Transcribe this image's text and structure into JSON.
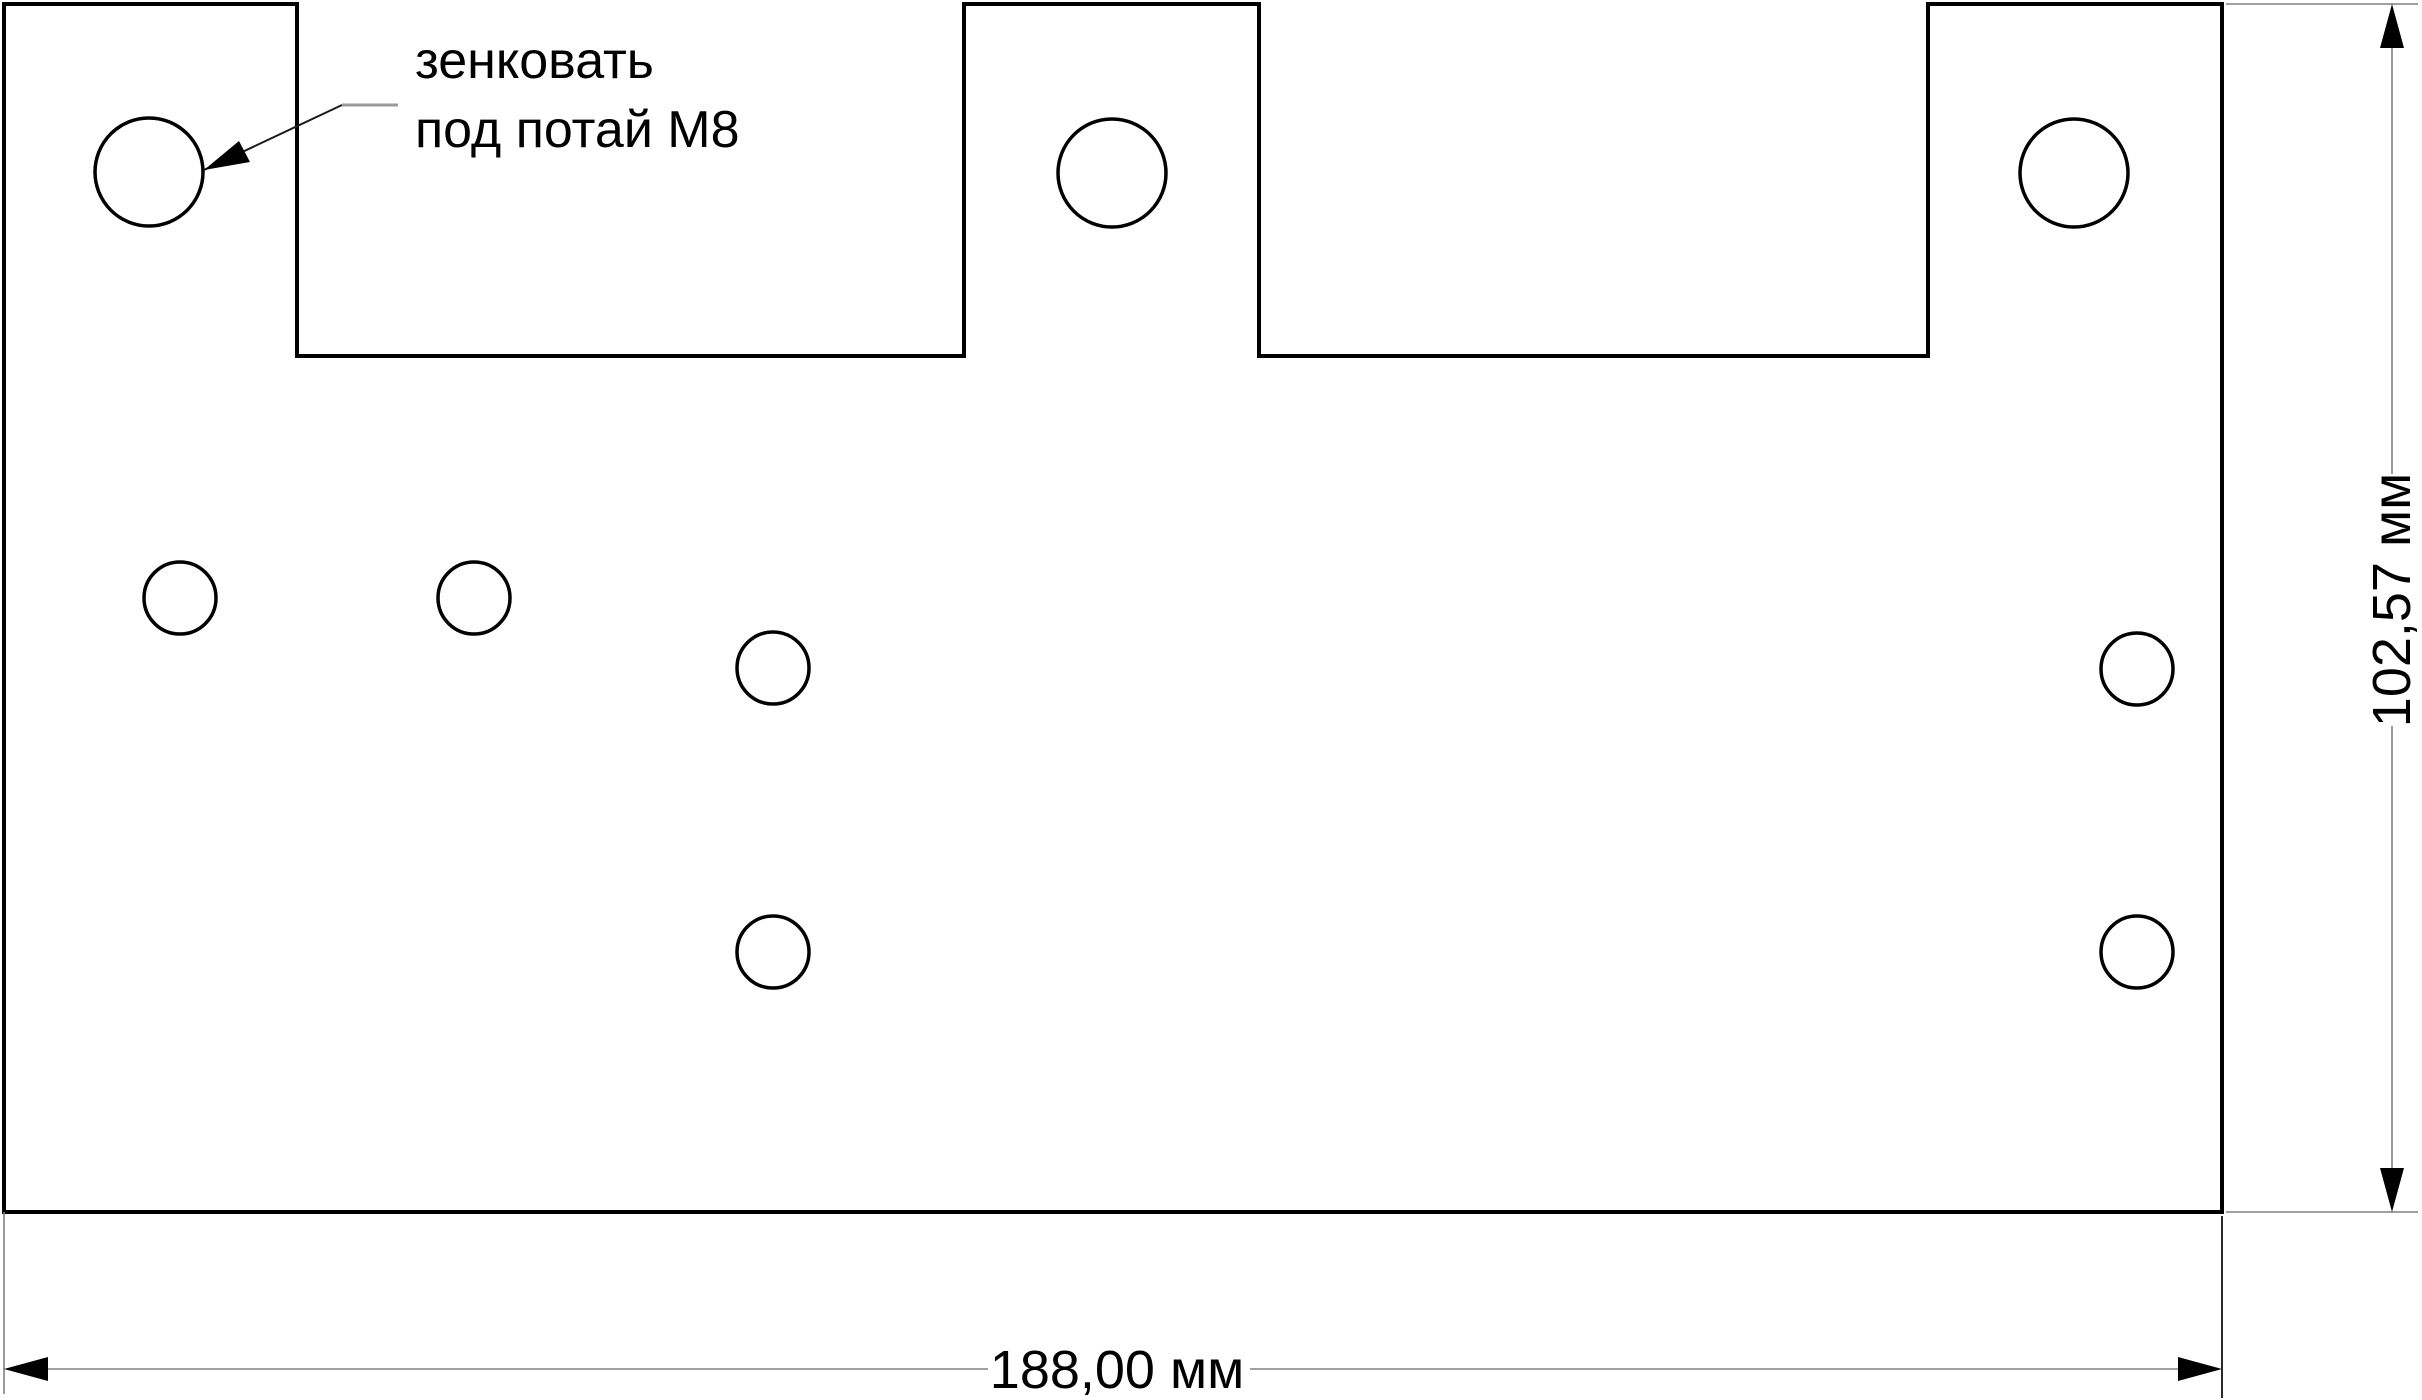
{
  "drawing": {
    "type": "technical-drawing",
    "background_color": "#ffffff",
    "outline_color": "#000000",
    "dim_line_color": "#808080",
    "annotation": {
      "line1": "зенковать",
      "line2": "под потай М8"
    },
    "dimensions": {
      "width_label": "188,00 мм",
      "height_label": "102,57 мм"
    },
    "part": {
      "tabs_on_top": 3,
      "holes_large": 3,
      "holes_small": 6
    }
  }
}
